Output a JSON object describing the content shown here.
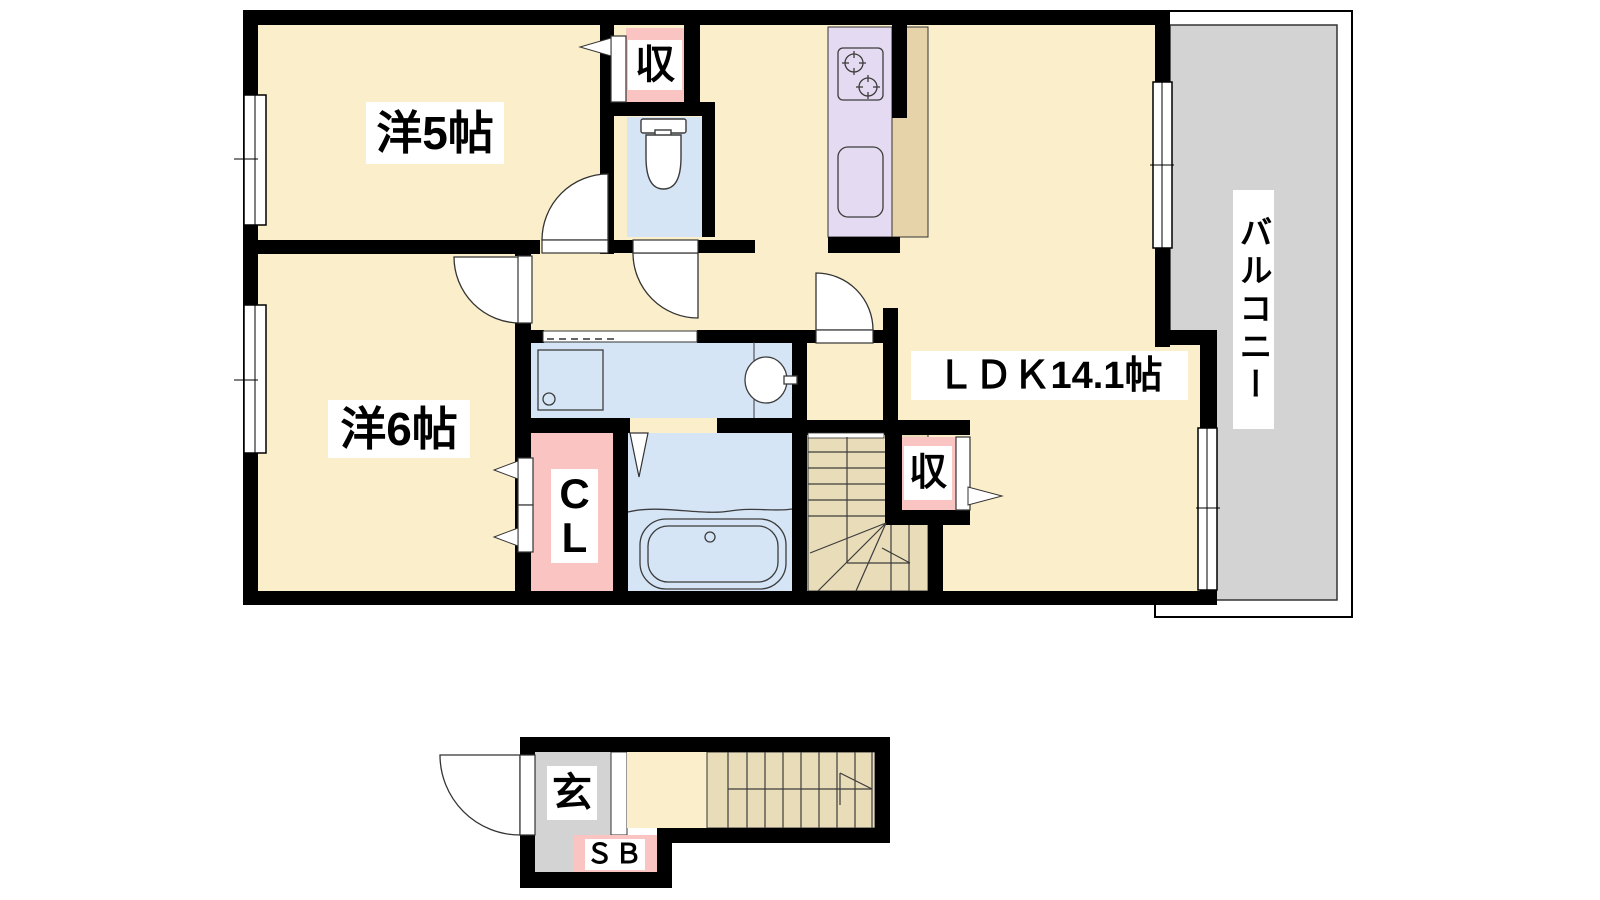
{
  "document": {
    "type": "apartment-floorplan",
    "floors": [
      "upper",
      "lower"
    ]
  },
  "colors": {
    "wall": "#000000",
    "floor-cream": "#FBEFCB",
    "floor-beige": "#E9DCB9",
    "counter-beige": "#E7D3A9",
    "room-pink": "#FAC4C3",
    "room-blue": "#D6E5F6",
    "kitchen-purple": "#E4DAF1",
    "balcony-gray": "#D3D3D3",
    "genkan-gray": "#D3D3D3",
    "line": "#3C3C3C"
  },
  "plan": {
    "upper_floor": {
      "room5": "洋5帖",
      "room6": "洋6帖",
      "ldk": "ＬＤＫ14.1帖",
      "balcony": "バルコニー",
      "storage_top": "収",
      "storage_stairs": "収",
      "closet": "CL"
    },
    "lower_floor": {
      "entrance": "玄",
      "shoe_box": "ＳＢ"
    }
  }
}
